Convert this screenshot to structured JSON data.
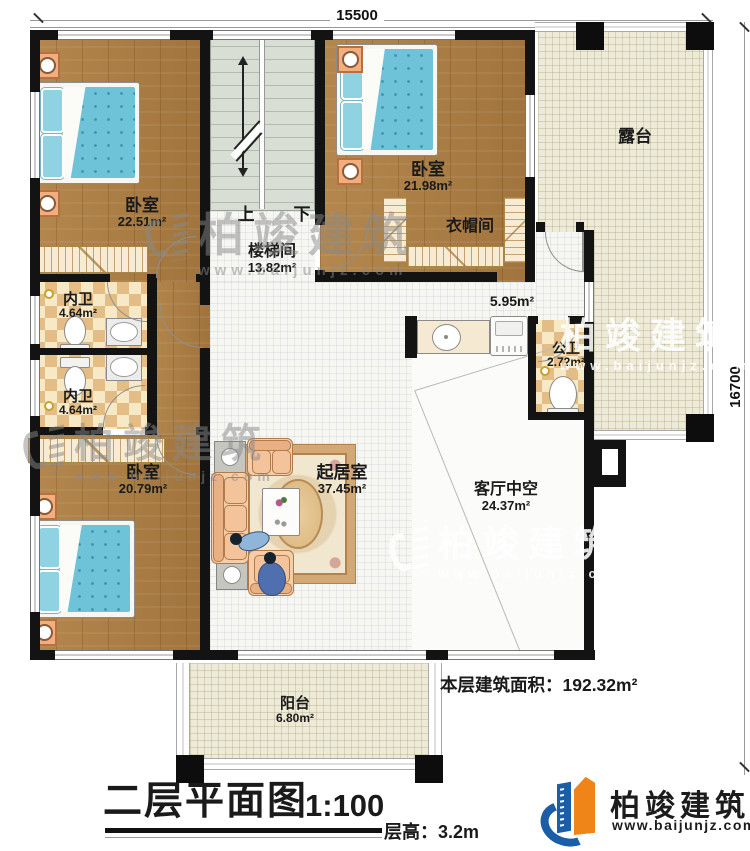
{
  "plan": {
    "dim_top": "15500",
    "dim_right": "16700",
    "stairs_up": "上",
    "stairs_down": "下"
  },
  "rooms": {
    "bedroom_tl": {
      "label": "卧室",
      "area": "22.51m²"
    },
    "stairwell": {
      "label": "楼梯间",
      "area": "13.82m²"
    },
    "bedroom_tr": {
      "label": "卧室",
      "area": "21.98m²"
    },
    "cloakroom": {
      "label": "衣帽间"
    },
    "terrace": {
      "label": "露台"
    },
    "ensuite_top": {
      "label": "内卫",
      "area": "4.64m²"
    },
    "ensuite_bottom": {
      "label": "内卫",
      "area": "4.64m²"
    },
    "hallway": {
      "area": "5.95m²"
    },
    "public_bath": {
      "label": "公卫",
      "area": "2.72m²"
    },
    "bedroom_bl": {
      "label": "卧室",
      "area": "20.79m²"
    },
    "living_room": {
      "label": "起居室",
      "area": "37.45m²"
    },
    "void": {
      "label": "客厅中空",
      "area": "24.37m²"
    },
    "balcony": {
      "label": "阳台",
      "area": "6.80m²"
    }
  },
  "annotations": {
    "floor_area": "本层建筑面积：192.32m²",
    "title": "二层平面图",
    "scale": "1:100",
    "floor_height": "层高：3.2m"
  },
  "brand": {
    "name": "柏竣建筑",
    "url": "www.baijunjz.com"
  },
  "watermark": {
    "name": "柏竣建筑",
    "url": "www.baijunjz.com"
  }
}
